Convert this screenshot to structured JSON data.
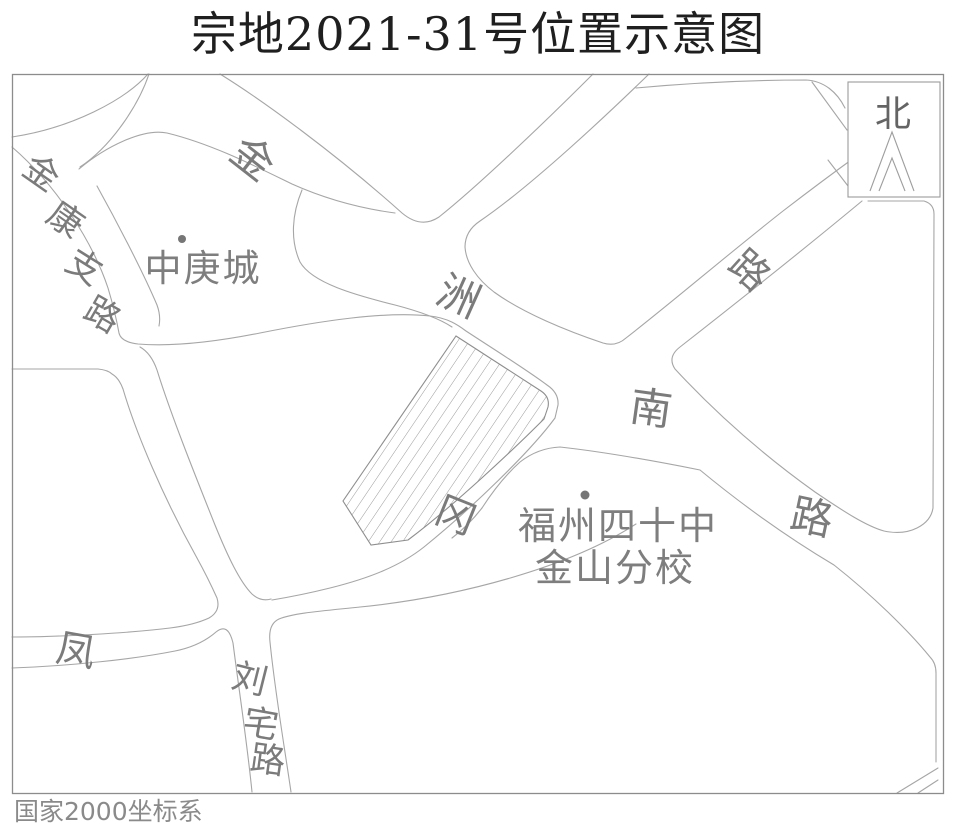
{
  "title": "宗地2021-31号位置示意图",
  "map": {
    "coordinate_system": "国家2000坐标系",
    "north_box": {
      "label": "北"
    },
    "parcel": {
      "id": "宗地2021-31号",
      "style": "hatched-wedge"
    },
    "places": {
      "zhonggengcheng": {
        "name": "中庚城"
      },
      "school": {
        "name": "福州四十中金山分校",
        "line1": "福州四十中",
        "line2": "金山分校"
      }
    },
    "roads": {
      "jinkangzhilu": {
        "name": "金康支路",
        "chars": [
          "金",
          "康",
          "支",
          "路"
        ]
      },
      "jinzhounanlu": {
        "name": "金洲南路",
        "chars": [
          "金",
          "洲",
          "南",
          "路"
        ]
      },
      "fengganglu": {
        "name": "凤冈路",
        "chars": [
          "凤",
          "冈",
          "路"
        ]
      },
      "liuzhailu": {
        "name": "刘宅路",
        "chars": [
          "刘",
          "宅",
          "路"
        ]
      }
    },
    "icons": {
      "north_arrow": "nested-chevron-up"
    },
    "colors": {
      "road_edge": "#a6a6a6",
      "frame": "#8c8c8c",
      "label_gray": "#7b7b7b",
      "title_black": "#1f1f1f",
      "hatch": "#9a9a9a",
      "background": "#ffffff"
    }
  }
}
